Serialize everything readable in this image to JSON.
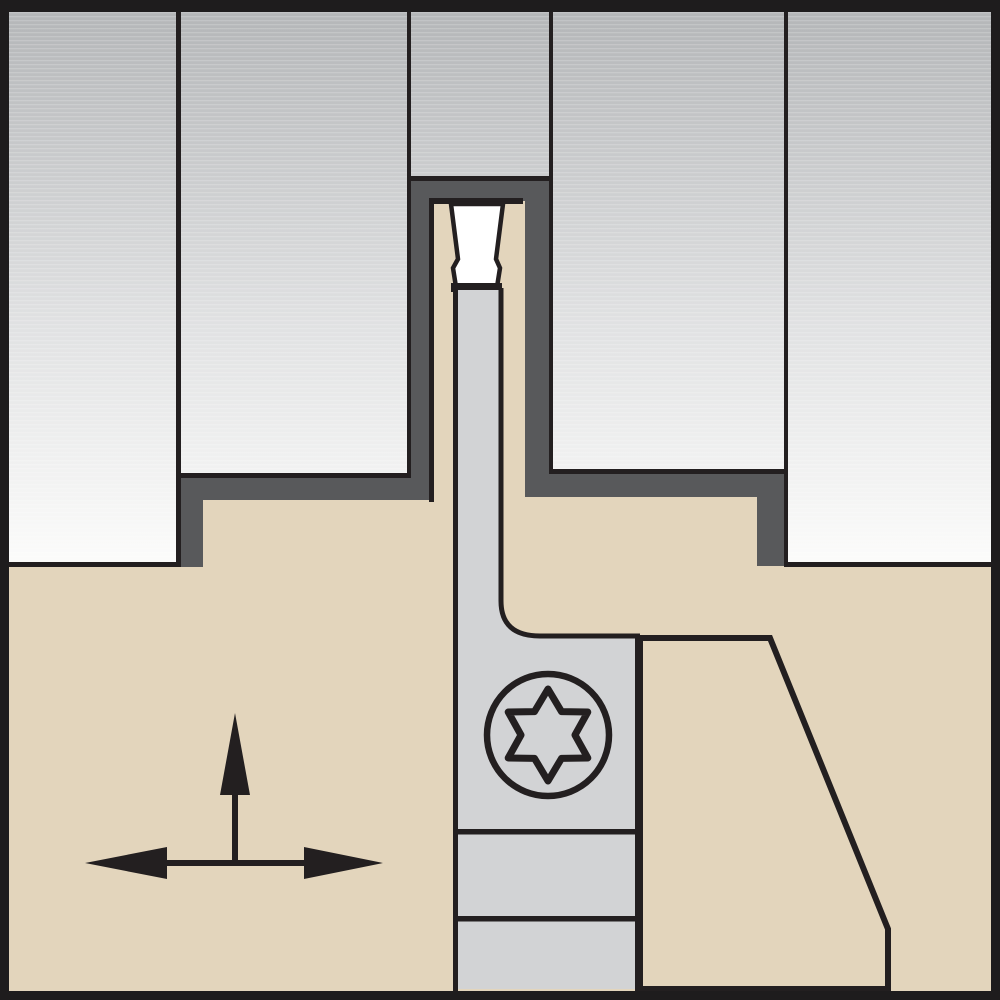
{
  "figure": {
    "kind": "tool-cross-section-diagram",
    "visible_text": "",
    "icons": {
      "screw": "torx-screw-icon",
      "arrows": "feed-direction-arrows-icon"
    }
  },
  "colors": {
    "ink": "#231f20",
    "frame": "#1e1c1d",
    "tan": "#e3d5bc",
    "charcoal": "#58595b",
    "panel_grad_top": "#b4b6b8",
    "panel_grad_mid": "#e0e1e2",
    "panel_grad_bottom": "#fdfdfc",
    "blade_gray": "#d2d3d5",
    "insert_white": "#ffffff",
    "screw_head_gray": "#a8aaad",
    "screw_star_gray": "#9b9da0",
    "scanline_white": "#ffffff"
  }
}
